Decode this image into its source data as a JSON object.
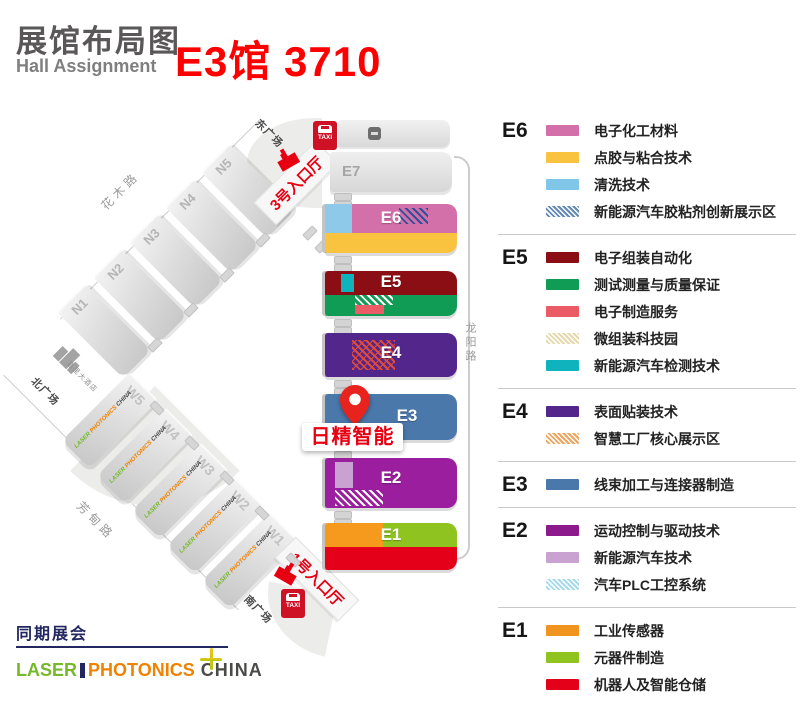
{
  "header": {
    "title": "展馆布局图",
    "subtitle": "Hall Assignment",
    "booth": "E3馆 3710"
  },
  "colors": {
    "booth_red": "#fe0000",
    "accent_red": "#e60012",
    "navy": "#23275f"
  },
  "brand": {
    "laser": "LASER",
    "photonics": "PHOTONICS",
    "china": "CHINA"
  },
  "map": {
    "north_halls": [
      "N1",
      "N2",
      "N3",
      "N4",
      "N5"
    ],
    "west_halls": [
      "W1",
      "W2",
      "W3",
      "W4",
      "W5"
    ],
    "e_halls": {
      "e7": "E7",
      "e6": "E6",
      "e5": "E5",
      "e4": "E4",
      "e3": "E3",
      "e2": "E2",
      "e1": "E1"
    },
    "roads": {
      "north": "花木路",
      "west": "芳甸路",
      "east": "龙阳路"
    },
    "plazas": {
      "east": "东广场",
      "north": "北广场",
      "south": "南广场"
    },
    "hotel": "嘉里大酒店",
    "entrances": {
      "north": "3号入口厅",
      "south": "1号入口厅"
    },
    "taxi": "TAXI",
    "pin_label": "日精智能",
    "colors": {
      "e6_left": "#8fc9e9",
      "e6_main": "#d36fa9",
      "e6_bottom": "#f9c33f",
      "e5_top": "#8b0e14",
      "e5_block": "#0fb3bd",
      "e5_bottom": "#119c55",
      "e5_sub": "#ea5b66",
      "e4_main": "#53268b",
      "e3_main": "#4a78ab",
      "e2_main": "#9b1e9e",
      "e2_patch": "#c9a2d2",
      "e1_left": "#f59a1c",
      "e1_right": "#8fc320",
      "e1_bottom": "#e50019"
    }
  },
  "legend": {
    "sections": [
      {
        "id": "E6",
        "items": [
          {
            "label": "电子化工材料",
            "color": "#d36fa9",
            "pattern": "solid"
          },
          {
            "label": "点胶与粘合技术",
            "color": "#f9c33f",
            "pattern": "solid"
          },
          {
            "label": "清洗技术",
            "color": "#7fc6e8",
            "pattern": "solid"
          },
          {
            "label": "新能源汽车胶粘剂创新展示区",
            "color": "#6589b6",
            "pattern": "hatch"
          }
        ]
      },
      {
        "id": "E5",
        "items": [
          {
            "label": "电子组装自动化",
            "color": "#8b0e14",
            "pattern": "solid"
          },
          {
            "label": "测试测量与质量保证",
            "color": "#119c55",
            "pattern": "solid"
          },
          {
            "label": "电子制造服务",
            "color": "#ea5b66",
            "pattern": "solid"
          },
          {
            "label": "微组装科技园",
            "color": "#e5d9ac",
            "pattern": "hatch"
          },
          {
            "label": "新能源汽车检测技术",
            "color": "#0fb3bd",
            "pattern": "solid"
          }
        ]
      },
      {
        "id": "E4",
        "items": [
          {
            "label": "表面贴装技术",
            "color": "#53268b",
            "pattern": "solid"
          },
          {
            "label": "智慧工厂核心展示区",
            "color": "#eda45e",
            "pattern": "hatch"
          }
        ]
      },
      {
        "id": "E3",
        "items": [
          {
            "label": "线束加工与连接器制造",
            "color": "#4a78ab",
            "pattern": "solid"
          }
        ]
      },
      {
        "id": "E2",
        "items": [
          {
            "label": "运动控制与驱动技术",
            "color": "#8d1a8d",
            "pattern": "solid"
          },
          {
            "label": "新能源汽车技术",
            "color": "#c9a2d2",
            "pattern": "solid"
          },
          {
            "label": "汽车PLC工控系统",
            "color": "#a6d9ea",
            "pattern": "hatch"
          }
        ]
      },
      {
        "id": "E1",
        "items": [
          {
            "label": "工业传感器",
            "color": "#f0931f",
            "pattern": "solid"
          },
          {
            "label": "元器件制造",
            "color": "#8fc320",
            "pattern": "solid"
          },
          {
            "label": "机器人及智能仓储",
            "color": "#e50019",
            "pattern": "solid"
          }
        ]
      }
    ]
  },
  "footer": {
    "concurrent": "同期展会"
  }
}
